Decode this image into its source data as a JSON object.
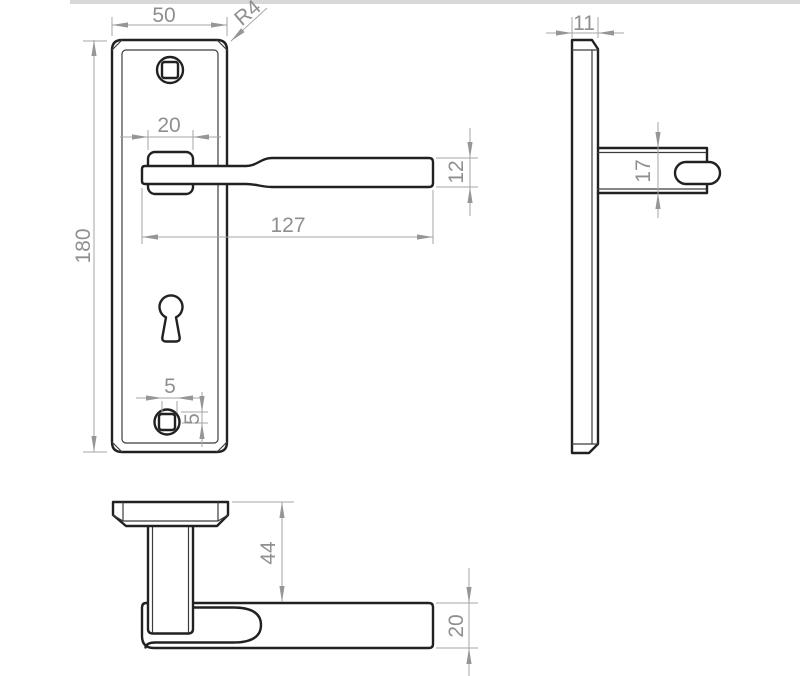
{
  "canvas": {
    "width": 800,
    "height": 676,
    "background": "#ffffff",
    "top_strip_color": "#d8d8d8"
  },
  "style": {
    "outline_color": "#212121",
    "detail_line_color": "#3c3c3c",
    "dimension_line_color": "#a6a6a6",
    "dimension_text_color": "#8f8f8f"
  },
  "drawing": {
    "type": "technical-orthographic-drawing",
    "dimensions": {
      "front_plate_width": "50",
      "front_corner_radius": "R4",
      "front_plate_height": "180",
      "front_boss_width": "20",
      "front_lever_length": "127",
      "front_lever_height": "12",
      "front_screw_hole_width": "5",
      "front_screw_hole_offset": "5",
      "side_plate_thickness": "11",
      "side_lever_thickness": "17",
      "bottom_handle_projection": "44",
      "bottom_lever_depth": "20"
    }
  }
}
